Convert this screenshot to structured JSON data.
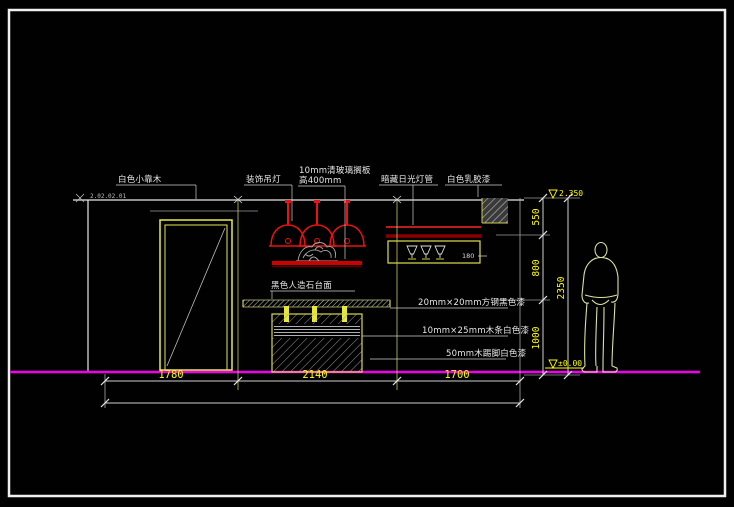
{
  "drawing": {
    "callouts": {
      "wall_top": "白色小靠木",
      "pendant_lamp": "装饰吊灯",
      "glass_shelf_line1": "10mm清玻璃搁板",
      "glass_shelf_line2": "高400mm",
      "cove_light": "暗藏日光灯管",
      "wall_finish": "白色乳胶漆",
      "counter_top": "黑色人造石台面",
      "steel_frame": "20mm×20mm方钢黑色漆",
      "wood_strip": "10mm×25mm木条白色漆",
      "skirting": "50mm木踢脚白色漆"
    },
    "dimensions": {
      "bottom": [
        "1780",
        "2140",
        "1700"
      ],
      "right": [
        "550",
        "800",
        "1000"
      ],
      "right_total": "2350",
      "cabinet_inner": "180"
    },
    "elevations": {
      "ceiling": "2.350",
      "floor": "±0.00",
      "ceiling_note": "2.02.02.01"
    },
    "colors": {
      "line_accent": "#ffff00",
      "floor_line": "#ee00ee",
      "lamp_red": "#ee1111",
      "cove_dark_red": "#8b0000",
      "figure_outline": "#d8e4a0",
      "background": "#010101"
    }
  }
}
